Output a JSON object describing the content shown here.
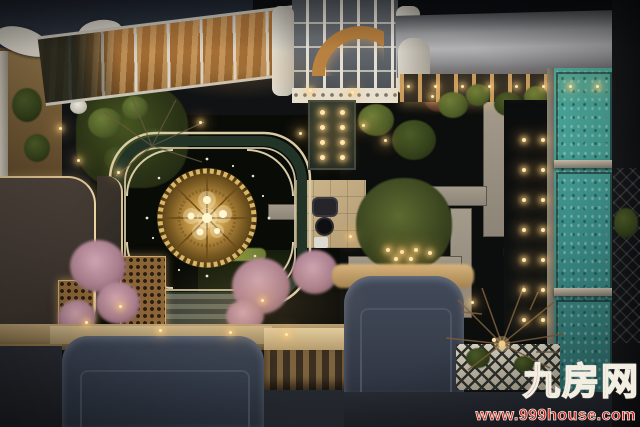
{
  "watermark": {
    "site_name": "九房网",
    "site_url": "www.999house.com",
    "color": "#c6181c"
  },
  "scene": {
    "type": "aerial-night-photograph",
    "subject": "top-down night view of a luxury residential courtyard garden",
    "regions": [
      "navy pavilion roofs",
      "glass canopy with amber marble floor",
      "entrance skylight with arch",
      "dark marble walkway with recessed lights",
      "central black plaza with ornate quatrefoil frame",
      "golden mandala medallion with lights",
      "garden islands with shrubs and trees",
      "pink blossom trees",
      "stone paths and terrace with furniture",
      "reflecting water with rows of lights",
      "teal swimming pool behind glass panels",
      "white trellis pergola",
      "red watermark"
    ],
    "palette": {
      "roof_navy": "#333b49",
      "plaza_black": "#0b0d09",
      "frame_cream": "#d8cca8",
      "frame_green": "#223428",
      "mandala_gold": "#d9b568",
      "marble_amber": "#b5793c",
      "pool_teal": "#3f948e",
      "foliage_green": "#4c5a26",
      "blossom_pink": "#b98b99",
      "stone_beige": "#c2ab81",
      "warm_light": "#ffd98f",
      "watermark_red": "#c6181c"
    }
  }
}
